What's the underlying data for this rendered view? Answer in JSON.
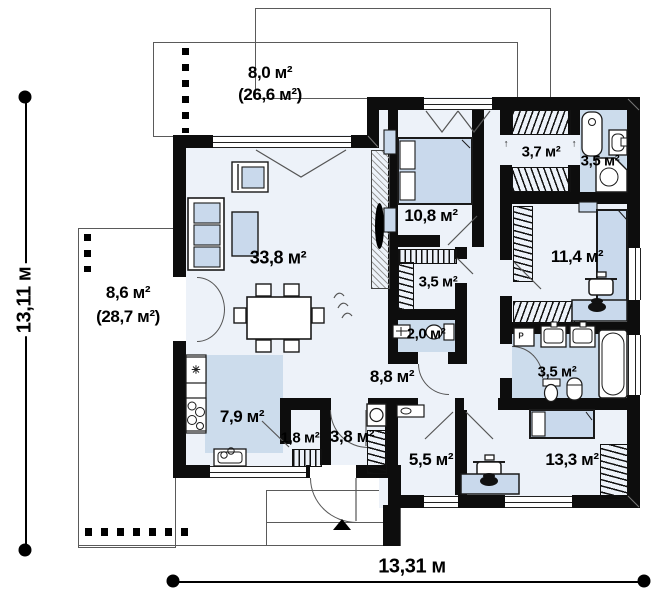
{
  "document": {
    "type": "floor-plan",
    "floor": "ground"
  },
  "dimensions": {
    "height_label": "13,11 м",
    "width_label": "13,31 м"
  },
  "rooms": {
    "terrace_top": {
      "area": "8,0 м²",
      "total": "(26,6 м²)"
    },
    "terrace_side": {
      "area": "8,6 м²",
      "total": "(28,7 м²)"
    },
    "living_room": {
      "area": "33,8 м²"
    },
    "bedroom_top": {
      "area": "10,8 м²"
    },
    "wardrobe_top": {
      "area": "3,7 м²"
    },
    "bathroom_top": {
      "area": "3,5 м²"
    },
    "bedroom_right": {
      "area": "11,4 м²"
    },
    "wardrobe_mid": {
      "area": "3,5 м²"
    },
    "wc": {
      "area": "2,0 м²"
    },
    "hallway": {
      "area": "8,8 м²"
    },
    "bathroom_bottom": {
      "area": "3,5 м²"
    },
    "kitchen": {
      "area": "7,9 м²"
    },
    "closet": {
      "area": "1,8 м²"
    },
    "entry": {
      "area": "3,8 м²"
    },
    "utility": {
      "area": "5,5 м²"
    },
    "bedroom_bottom": {
      "area": "13,3 м²"
    }
  },
  "icons": {
    "door_arrow": "↑",
    "fridge_symbol": "✳",
    "washer_symbol": "P"
  },
  "colors": {
    "wall": "#0d0d0d",
    "floor": "#edf2f9",
    "wet_zone": "#ccdcec",
    "furniture_fill": "#c9d9ec",
    "outline": "#5a5a5a"
  }
}
